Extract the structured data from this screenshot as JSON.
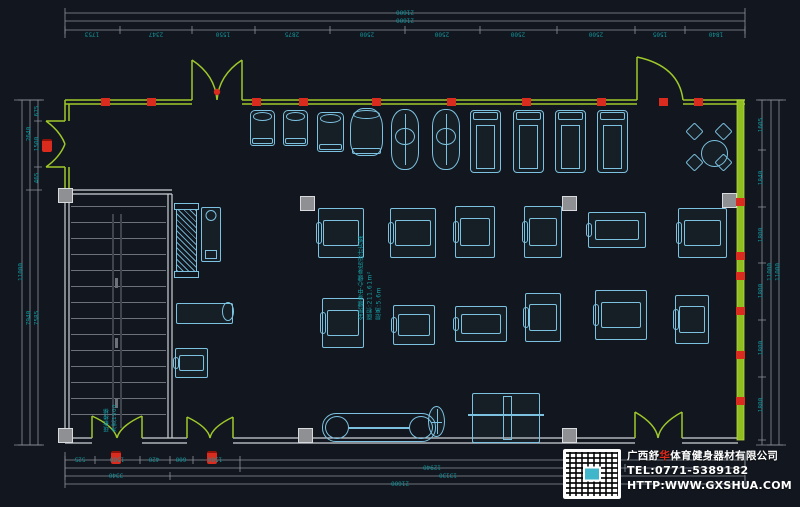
{
  "colors": {
    "background": "#12171f",
    "wall_green": "#9fc82a",
    "wall_green_fill": "#8fbe1e",
    "grey_wall": "#cdd1d6",
    "dim_line": "#8e939b",
    "dim_text": "#12939b",
    "equipment_cyan": "#7cc2e0",
    "marker_red": "#d92b1e"
  },
  "branding": {
    "company_pre": "广西舒",
    "company_red": "华",
    "company_post": "体育健身器材有限公司",
    "tel": "TEL:0771-5389182",
    "url": "HTTP:WWW.GXSHUA.COM"
  },
  "annotations": {
    "plan_title_lines": [
      "全民健身中心健身房设计方案",
      "面积:211.61m²",
      "层高:5.6m"
    ],
    "stair_note_lines": [
      "疏散楼梯",
      "净宽1500"
    ]
  },
  "dimensions": {
    "top_overall": [
      "21600",
      "21600"
    ],
    "top_segments": [
      "1753",
      "2347",
      "1550",
      "2875",
      "2500",
      "2500",
      "2500",
      "2500",
      "1505",
      "1840"
    ],
    "bottom_segments": [
      "525",
      "1500",
      "420",
      "600",
      "1500"
    ],
    "bottom_row_b": [
      "12940"
    ],
    "bottom_row_c": [
      "3340",
      "13130"
    ],
    "bottom_overall": [
      "21600"
    ],
    "left_segments": [
      "675",
      "1500",
      "465",
      "7585"
    ],
    "left_mid": [
      "2640",
      "7940"
    ],
    "left_overall": [
      "11000"
    ],
    "right_segments": [
      "1605",
      "1840",
      "1800",
      "1800",
      "1800",
      "1800"
    ],
    "right_overall": [
      "11000",
      "11000"
    ]
  },
  "dim_labels": [
    {
      "t": "21600",
      "x": 405,
      "y": 12,
      "o": "u"
    },
    {
      "t": "21600",
      "x": 405,
      "y": 20,
      "o": "u"
    },
    {
      "t": "1753",
      "x": 92,
      "y": 34,
      "o": "u"
    },
    {
      "t": "2347",
      "x": 156,
      "y": 34,
      "o": "u"
    },
    {
      "t": "1550",
      "x": 223,
      "y": 34,
      "o": "u"
    },
    {
      "t": "2875",
      "x": 292,
      "y": 34,
      "o": "u"
    },
    {
      "t": "2500",
      "x": 367,
      "y": 34,
      "o": "u"
    },
    {
      "t": "2500",
      "x": 442,
      "y": 34,
      "o": "u"
    },
    {
      "t": "2500",
      "x": 518,
      "y": 34,
      "o": "u"
    },
    {
      "t": "2500",
      "x": 596,
      "y": 34,
      "o": "u"
    },
    {
      "t": "1505",
      "x": 660,
      "y": 34,
      "o": "u"
    },
    {
      "t": "1840",
      "x": 716,
      "y": 34,
      "o": "u"
    },
    {
      "t": "525",
      "x": 80,
      "y": 459,
      "o": "u"
    },
    {
      "t": "1500",
      "x": 117,
      "y": 459,
      "o": "u"
    },
    {
      "t": "420",
      "x": 154,
      "y": 459,
      "o": "u"
    },
    {
      "t": "600",
      "x": 181,
      "y": 459,
      "o": "u"
    },
    {
      "t": "1500",
      "x": 215,
      "y": 459,
      "o": "u"
    },
    {
      "t": "12940",
      "x": 432,
      "y": 467,
      "o": "u"
    },
    {
      "t": "3340",
      "x": 116,
      "y": 475,
      "o": "u"
    },
    {
      "t": "13130",
      "x": 448,
      "y": 475,
      "o": "u"
    },
    {
      "t": "21600",
      "x": 400,
      "y": 483,
      "o": "u"
    },
    {
      "t": "675",
      "x": 37,
      "y": 111,
      "o": "v"
    },
    {
      "t": "1500",
      "x": 37,
      "y": 144,
      "o": "v"
    },
    {
      "t": "465",
      "x": 37,
      "y": 178,
      "o": "v"
    },
    {
      "t": "7585",
      "x": 37,
      "y": 318,
      "o": "v"
    },
    {
      "t": "2640",
      "x": 29,
      "y": 134,
      "o": "v"
    },
    {
      "t": "7940",
      "x": 29,
      "y": 318,
      "o": "v"
    },
    {
      "t": "11000",
      "x": 21,
      "y": 272,
      "o": "v"
    },
    {
      "t": "1605",
      "x": 761,
      "y": 125,
      "o": "v"
    },
    {
      "t": "1840",
      "x": 761,
      "y": 178,
      "o": "v"
    },
    {
      "t": "1800",
      "x": 761,
      "y": 235,
      "o": "v"
    },
    {
      "t": "1800",
      "x": 761,
      "y": 291,
      "o": "v"
    },
    {
      "t": "1800",
      "x": 761,
      "y": 348,
      "o": "v"
    },
    {
      "t": "1800",
      "x": 761,
      "y": 405,
      "o": "v"
    },
    {
      "t": "11000",
      "x": 770,
      "y": 272,
      "o": "v"
    },
    {
      "t": "11000",
      "x": 778,
      "y": 272,
      "o": "v"
    }
  ],
  "floor": {
    "equipment": [
      {
        "type": "spin-bike",
        "x": 250,
        "y": 110,
        "w": 25,
        "h": 36
      },
      {
        "type": "spin-bike",
        "x": 283,
        "y": 110,
        "w": 25,
        "h": 36
      },
      {
        "type": "upright-bike",
        "x": 317,
        "y": 112,
        "w": 27,
        "h": 40
      },
      {
        "type": "recumbent-bike",
        "x": 350,
        "y": 108,
        "w": 33,
        "h": 48
      },
      {
        "type": "elliptical",
        "x": 391,
        "y": 109,
        "w": 28,
        "h": 61
      },
      {
        "type": "elliptical",
        "x": 432,
        "y": 109,
        "w": 28,
        "h": 61
      },
      {
        "type": "treadmill",
        "x": 470,
        "y": 110,
        "w": 31,
        "h": 63
      },
      {
        "type": "treadmill",
        "x": 513,
        "y": 110,
        "w": 31,
        "h": 63
      },
      {
        "type": "treadmill",
        "x": 555,
        "y": 110,
        "w": 31,
        "h": 63
      },
      {
        "type": "treadmill",
        "x": 597,
        "y": 110,
        "w": 31,
        "h": 63
      },
      {
        "type": "round",
        "x": 701,
        "y": 140,
        "w": 27,
        "h": 27
      },
      {
        "type": "chair",
        "x": 688,
        "y": 125,
        "w": 13,
        "h": 13,
        "r": 45
      },
      {
        "type": "chair",
        "x": 717,
        "y": 125,
        "w": 13,
        "h": 13,
        "r": 45
      },
      {
        "type": "chair",
        "x": 688,
        "y": 156,
        "w": 13,
        "h": 13,
        "r": 45
      },
      {
        "type": "chair",
        "x": 717,
        "y": 156,
        "w": 13,
        "h": 13,
        "r": 45
      },
      {
        "type": "rack-v",
        "x": 176,
        "y": 203,
        "w": 21,
        "h": 75
      },
      {
        "type": "cooler",
        "x": 201,
        "y": 207,
        "w": 20,
        "h": 55
      },
      {
        "type": "machine",
        "x": 318,
        "y": 208,
        "w": 46,
        "h": 50
      },
      {
        "type": "machine",
        "x": 390,
        "y": 208,
        "w": 46,
        "h": 50
      },
      {
        "type": "machine",
        "x": 455,
        "y": 206,
        "w": 40,
        "h": 52
      },
      {
        "type": "machine",
        "x": 524,
        "y": 206,
        "w": 38,
        "h": 52
      },
      {
        "type": "machine",
        "x": 588,
        "y": 212,
        "w": 58,
        "h": 36
      },
      {
        "type": "machine",
        "x": 678,
        "y": 208,
        "w": 49,
        "h": 50
      },
      {
        "type": "bench",
        "x": 176,
        "y": 303,
        "w": 57,
        "h": 21
      },
      {
        "type": "machine",
        "x": 175,
        "y": 348,
        "w": 33,
        "h": 30
      },
      {
        "type": "machine",
        "x": 322,
        "y": 298,
        "w": 42,
        "h": 50
      },
      {
        "type": "machine",
        "x": 393,
        "y": 305,
        "w": 42,
        "h": 40
      },
      {
        "type": "machine",
        "x": 455,
        "y": 306,
        "w": 52,
        "h": 36
      },
      {
        "type": "machine",
        "x": 525,
        "y": 293,
        "w": 36,
        "h": 49
      },
      {
        "type": "machine",
        "x": 595,
        "y": 290,
        "w": 52,
        "h": 50
      },
      {
        "type": "machine",
        "x": 675,
        "y": 295,
        "w": 34,
        "h": 49
      },
      {
        "type": "plate-tree",
        "x": 428,
        "y": 406,
        "w": 17,
        "h": 31
      },
      {
        "type": "rack-long",
        "x": 322,
        "y": 413,
        "w": 114,
        "h": 29
      },
      {
        "type": "smith",
        "x": 472,
        "y": 393,
        "w": 68,
        "h": 50
      }
    ],
    "columns": [
      [
        58,
        188
      ],
      [
        300,
        196
      ],
      [
        562,
        196
      ],
      [
        722,
        193
      ],
      [
        58,
        428
      ],
      [
        298,
        428
      ],
      [
        562,
        428
      ]
    ],
    "red_ticks_top": [
      101,
      147,
      252,
      299,
      372,
      447,
      522,
      597,
      659,
      694
    ],
    "red_ticks_right": [
      198,
      252,
      272,
      307,
      351,
      397
    ],
    "hydrants": [
      [
        111,
        451
      ],
      [
        207,
        451
      ],
      [
        42,
        139
      ]
    ]
  }
}
